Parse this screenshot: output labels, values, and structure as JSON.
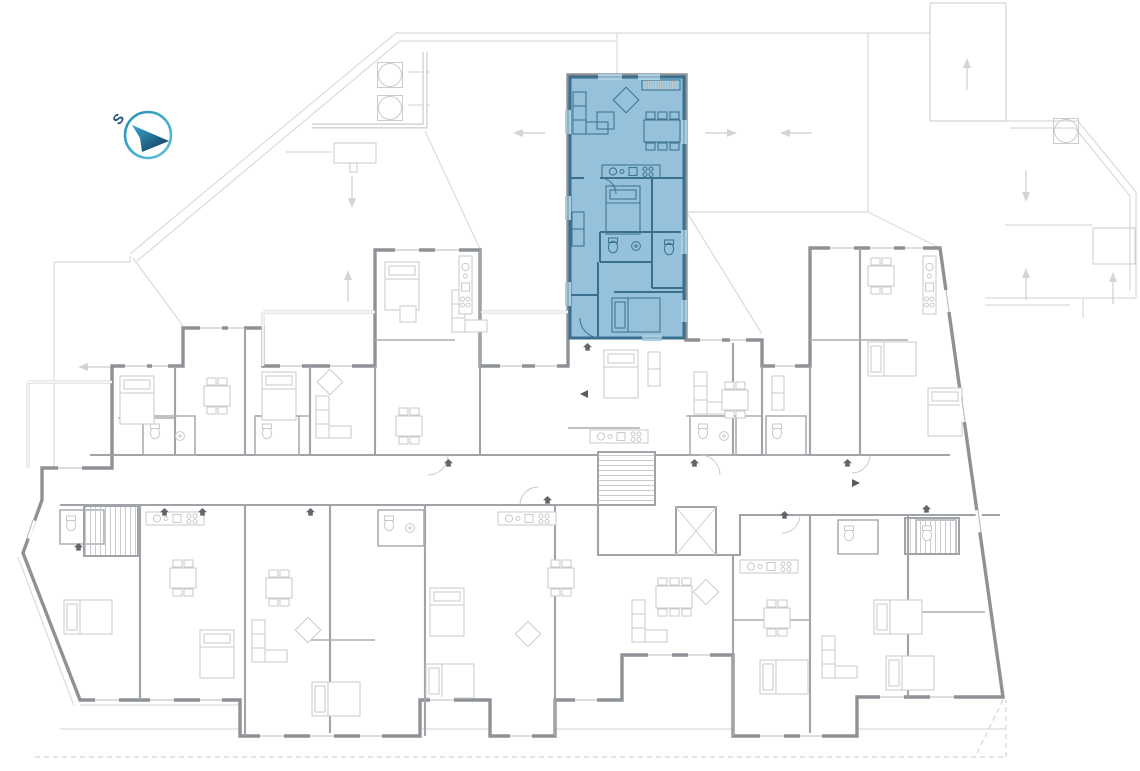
{
  "title": "Residential floor plan with selected apartment",
  "compass": {
    "label": "S"
  },
  "highlighted_unit": {
    "status": "selected",
    "fill": "#82b7d3",
    "fill_opacity": "0.85",
    "wall_color": "#3b6f8e",
    "furniture_color": "#3f7693",
    "window_gap_color": "#a9cfe3"
  },
  "plan_colors": {
    "outer_wall": "#8e9296",
    "partition": "#a0a4a8",
    "furniture": "#c7cacd",
    "terrace_line": "#d9dbdd",
    "roof_hatch": "#e0e2e5",
    "grate_hatch": "#c6c9cc",
    "entrance_marker": "#62666a",
    "compass_ring": "#2fa3c6",
    "compass_arrow_start": "#39a9cb",
    "compass_arrow_end": "#0f3258",
    "compass_label_color": "#1c4e7d"
  }
}
